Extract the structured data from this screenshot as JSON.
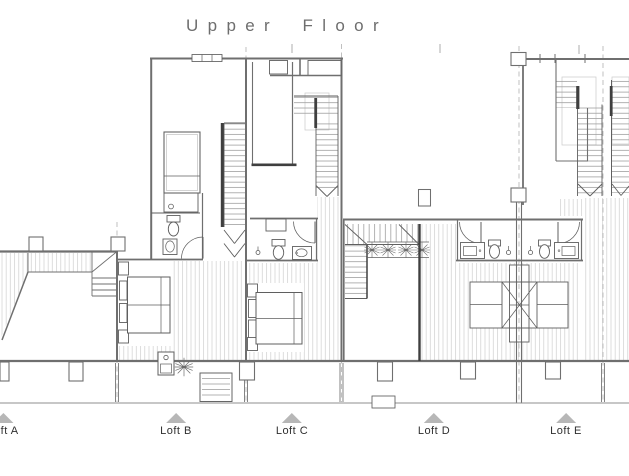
{
  "title": "Upper Floor",
  "units": [
    {
      "id": "loft-a",
      "label": "Loft A"
    },
    {
      "id": "loft-b",
      "label": "Loft B"
    },
    {
      "id": "loft-c",
      "label": "Loft C"
    },
    {
      "id": "loft-d",
      "label": "Loft D"
    },
    {
      "id": "loft-e",
      "label": "Loft E"
    }
  ],
  "colors": {
    "wall_line": "#6f6f6f",
    "dark_line": "#3f3f3f",
    "fixture_line": "#5f5f5f",
    "deck_hatch": "#cfcfcf",
    "stair_tread": "#a0a0a0",
    "grid_dash": "#a5a5a5",
    "marker_triangle": "#b7b7b7",
    "title_text": "#6e6e6e",
    "label_text": "#2f2f2f",
    "background": "#ffffff"
  }
}
